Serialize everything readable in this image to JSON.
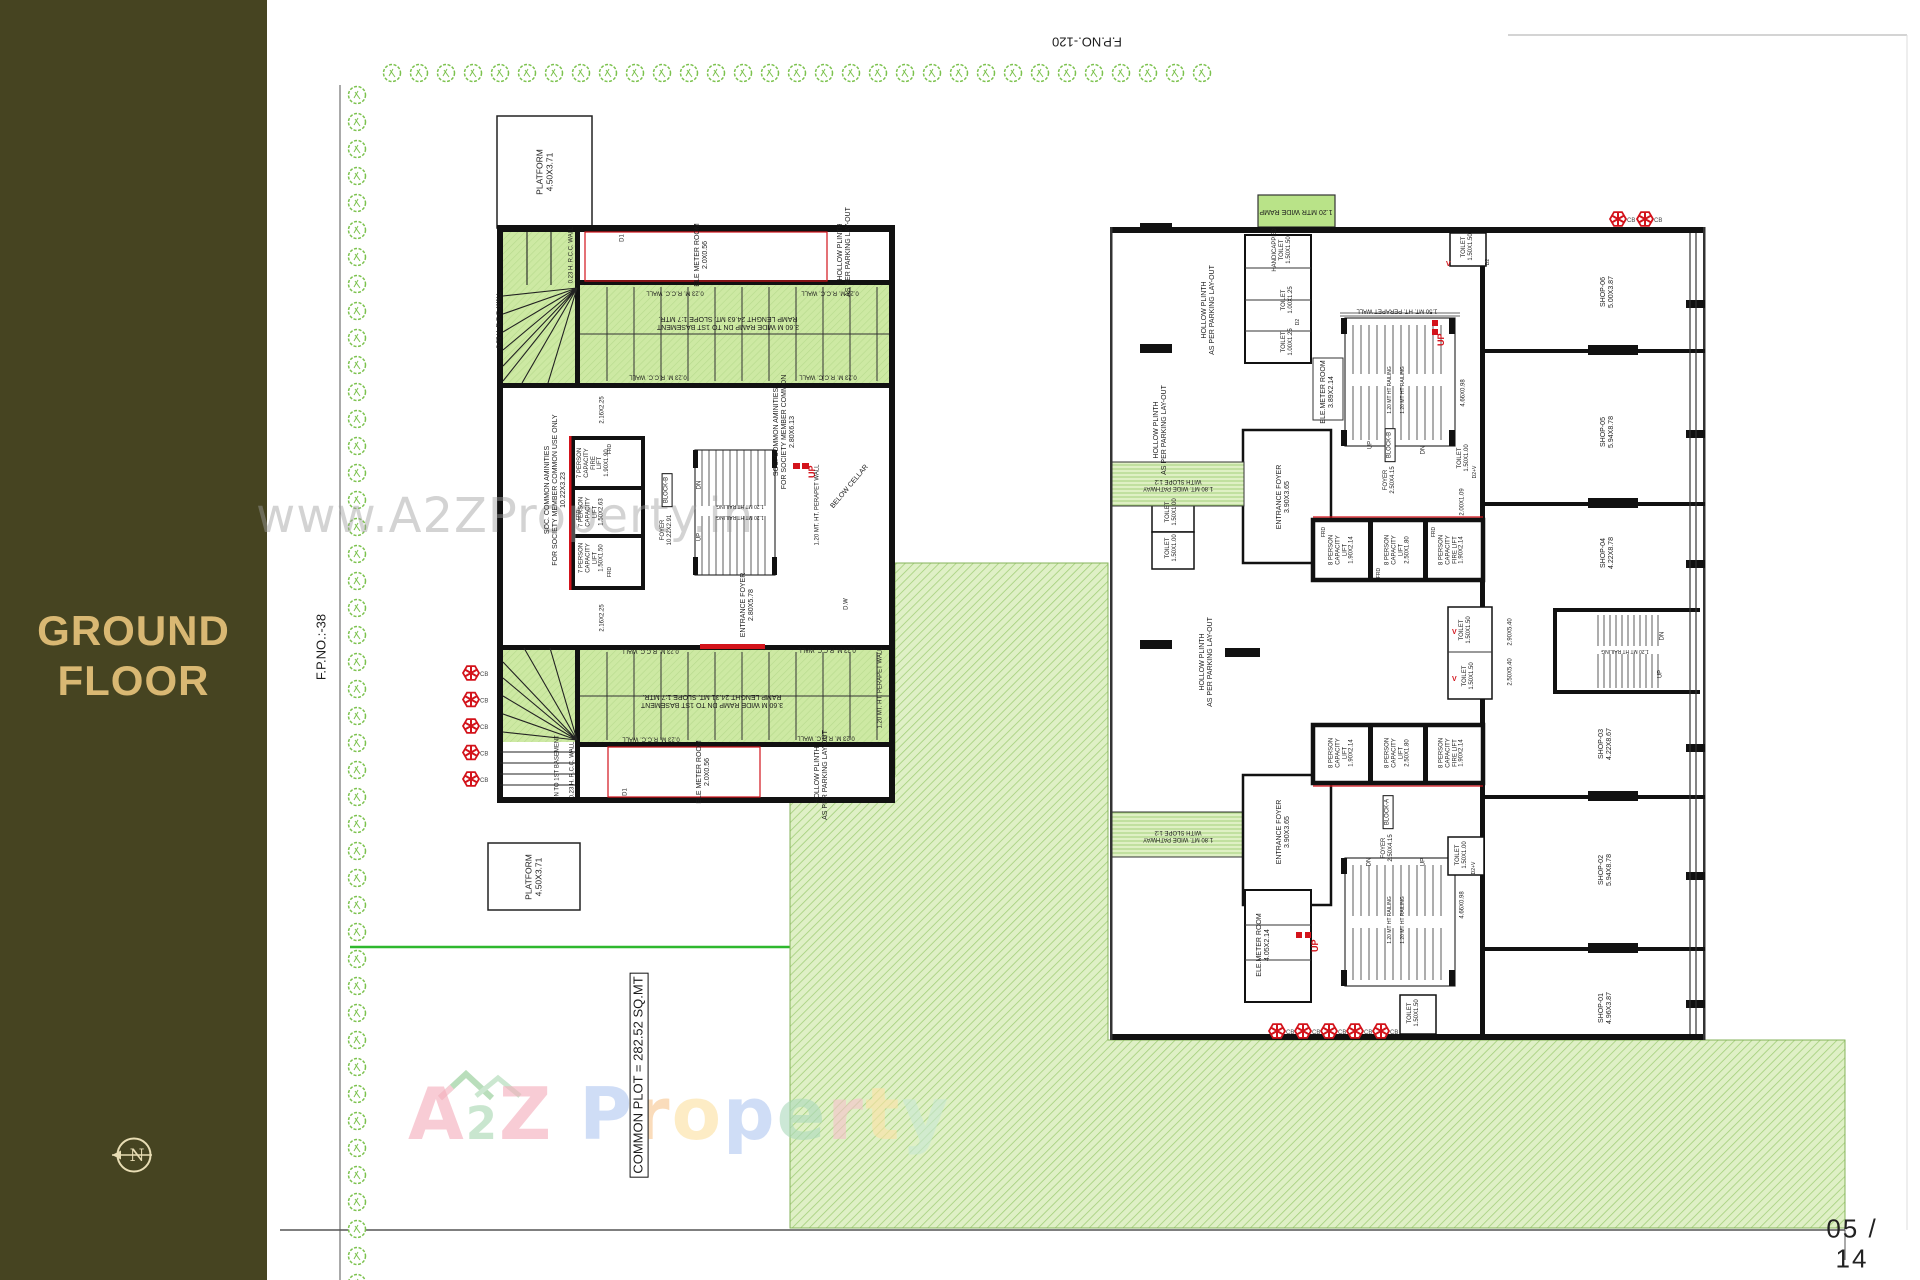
{
  "sidebar": {
    "title": "GROUND\nFLOOR",
    "compass_letter": "N"
  },
  "sheet": {
    "fp_top": "F.P.NO.-120",
    "fp_left": "F.P.NO.:-38",
    "page": "05 / 14",
    "common_plot": "COMMON PLOT = 282.52 SQ.MT"
  },
  "watermark": {
    "url": "www.A2ZProperty.in",
    "brand": {
      "a": "A",
      "two": "2",
      "z": "Z",
      "p1": "P",
      "r1": "r",
      "o1": "o",
      "p2": "p",
      "e1": "e",
      "r2": "r",
      "t1": "t",
      "y1": "y"
    }
  },
  "plan": {
    "cb": "CB",
    "up": "UP",
    "v": "V"
  },
  "left": {
    "platform": "PLATFORM\n4.50X3.71",
    "ele_meter": "ELE METER ROOM\n2.0X0.56",
    "hollow": "HOLLOW PLINTH\nAS PER PARKING LAY-OUT",
    "ramp_top": "3.60 M WIDE RAMP DN TO 1ST BASEMENT\nRAMP LENGHT 24.63 MT. SLOPE 1:7 MTR.",
    "ramp_bottom": "3.60 M WIDE RAMP DN TO 1ST BASEMENT\nRAMP LENGHT 24.31 MT. SLOPE 1:7 MTR.",
    "rcc": "0.23 M. R.C.C. WALL",
    "rcc_v": "0.23 H. R.C.C. WALL",
    "parapet": "1.20 MT. HT. PERAPET WALL",
    "soc1": "SOC. COMMON AMINITIES\nFOR SOCIETY MEMBER COMMON USE ONLY\n10.22X3.23",
    "soc2": "SOC. COMMON AMINITIES\nFOR SOCIETY MEMBER COMMON\n2.80X6.13",
    "lift_fire": "7 PERSON\nCAPACITY\nFIRE\nLIFT\n1.90X1.90",
    "lift_mid": "7 PERSON\nCAPACITY\nLIFT\n1.50X2.63",
    "lift_small": "7 PERSON\nCAPACITY\nLIFT\n1.50X1.50",
    "frd": "FRD",
    "block": "BLOCK-B",
    "foyer": "FOYER\n10.22X2.91",
    "dn": "DN",
    "up": "UP",
    "railing": "1.20 MT HT RAILING",
    "below_cellar": "BELOW CELLAR",
    "entrance": "ENTRANCE FOYER\n2.80X5.78",
    "dw": "D.W",
    "dn_basement": "DN TO 1ST BASEMENT",
    "dim": "2.16X2.25",
    "d1": "D1"
  },
  "right": {
    "ramp": "1.20 MTR WIDE RAMP",
    "pathway": "1.80 MT. WIDE PATHWAY\nWITH SLOPE 1:2",
    "hollow": "HOLLOW PLINTH\nAS PER PARKING LAY-OUT",
    "handicap": "HANDICAPPED\nTOILET\n1.50X1.50",
    "toilet_s": "TOILET\n1.00X1.25",
    "toilet_1515": "TOILET\n1.50X1.50",
    "toilet_1510": "TOILET\n1.50X1.00",
    "d2v": "D2+V",
    "d2": "D2",
    "ele_meter_t": "ELE.METER ROOM\n3.89X2.14",
    "ele_meter_b": "ELE.METER ROOM\n4.05X2.14",
    "perapet": "1.50 MT. HT. PERAPET WALL",
    "railing": "1.20 MT HT RAILING",
    "dim466": "4.66X0.98",
    "entrance": "ENTRANCE FOYER\n3.90X3.65",
    "block_b": "BLOCK-B",
    "block_a": "BLOCK-A",
    "foyer": "FOYER\n2.50X4.15",
    "lift_a": "8 PERSON\nCAPACITY\nLIFT\n1.90X2.14",
    "lift_b": "8 PERSON\nCAPACITY\nLIFT\n2.50X1.80",
    "lift_f": "8 PERSON\nCAPACITY\nFIRE LIFT\n1.90X2.14",
    "frd": "FRD",
    "dim200": "2.00X1.09",
    "shop6": "SHOP-06\n5.00X3.87",
    "shop5": "SHOP-05\n5.94X8.78",
    "shop4": "SHOP-04\n4.22X8.78",
    "shop3": "SHOP-03\n4.22X8.67",
    "shop2": "SHOP-02\n5.94X8.78",
    "shop1": "SHOP-01\n4.96X3.87",
    "sdim1": "2.90X5.40",
    "sdim2": "2.50X5.40",
    "dn": "DN",
    "up": "UP"
  },
  "colors": {
    "sidebar_bg": "#464421",
    "sidebar_text": "#d9b873",
    "tree_green": "#7cc24e",
    "lawn_green": "#dff0c6",
    "ramp_green": "#cde9a3",
    "red_accent": "#d3131b",
    "plot_line_green": "#2eb82e"
  }
}
